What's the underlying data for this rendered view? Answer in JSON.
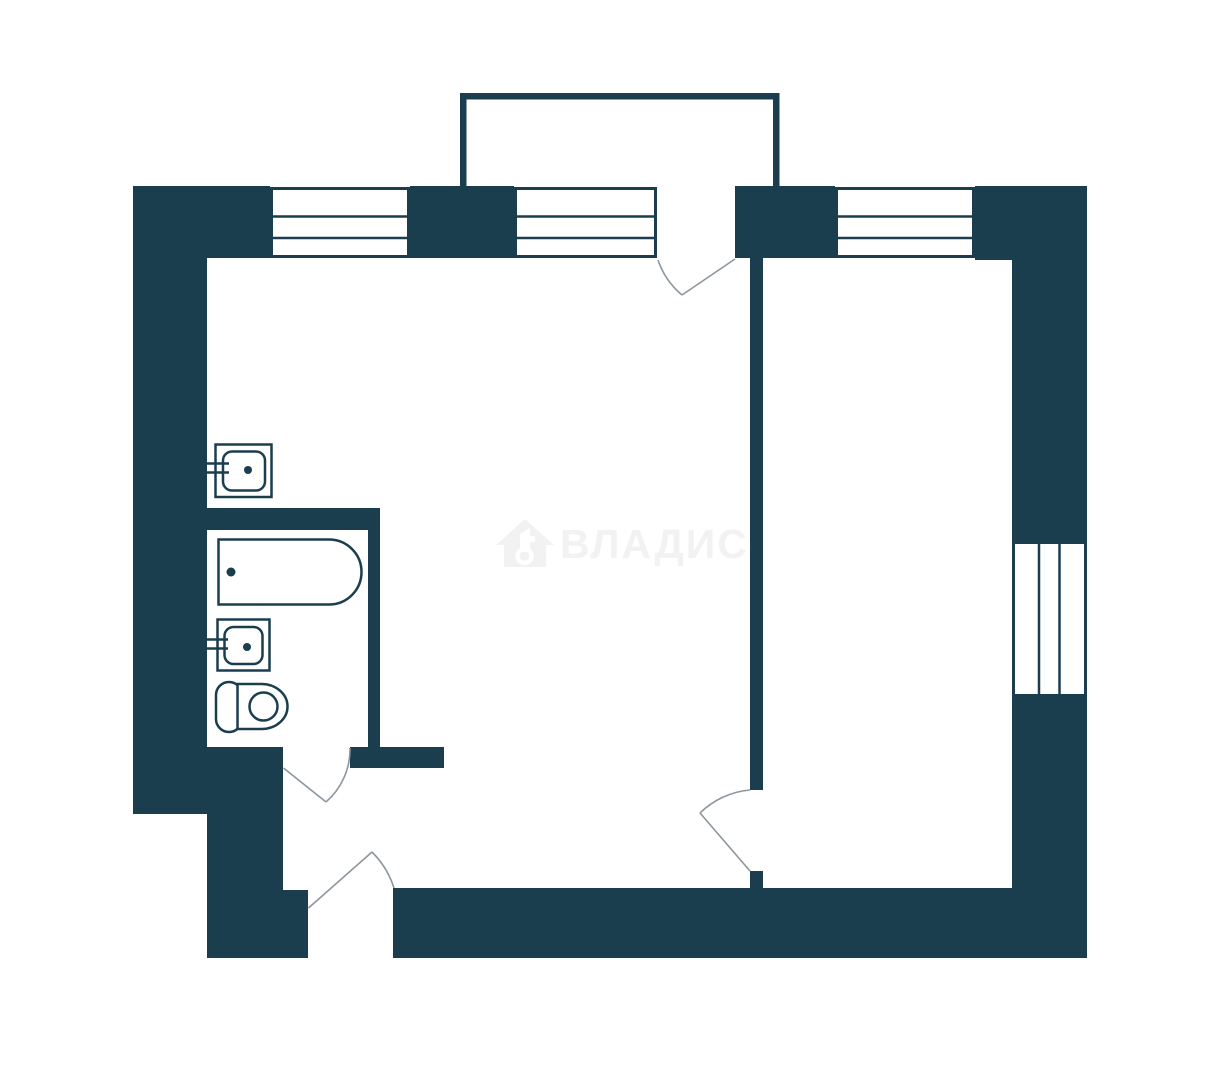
{
  "watermark": {
    "brand_text": "ВЛАДИС",
    "logo_icon": "house-key-icon"
  },
  "colors": {
    "wall": "#1A3E4E",
    "background": "#FFFFFF",
    "fixture_line": "#1A3E4E",
    "door_swing": "#8C969D",
    "watermark": "#F2F2F2"
  },
  "plan": {
    "type": "apartment-floor-plan",
    "areas": [
      "balcony",
      "living-room",
      "room",
      "bathroom",
      "hallway"
    ],
    "windows": [
      "kitchen-window",
      "balcony-side-window",
      "room-top-window",
      "room-right-window"
    ],
    "doors": [
      "balcony-door",
      "bathroom-door",
      "room-door",
      "entry-door"
    ],
    "fixtures": [
      "kitchen-sink-icon",
      "bathtub-icon",
      "washbasin-icon",
      "toilet-icon"
    ]
  }
}
